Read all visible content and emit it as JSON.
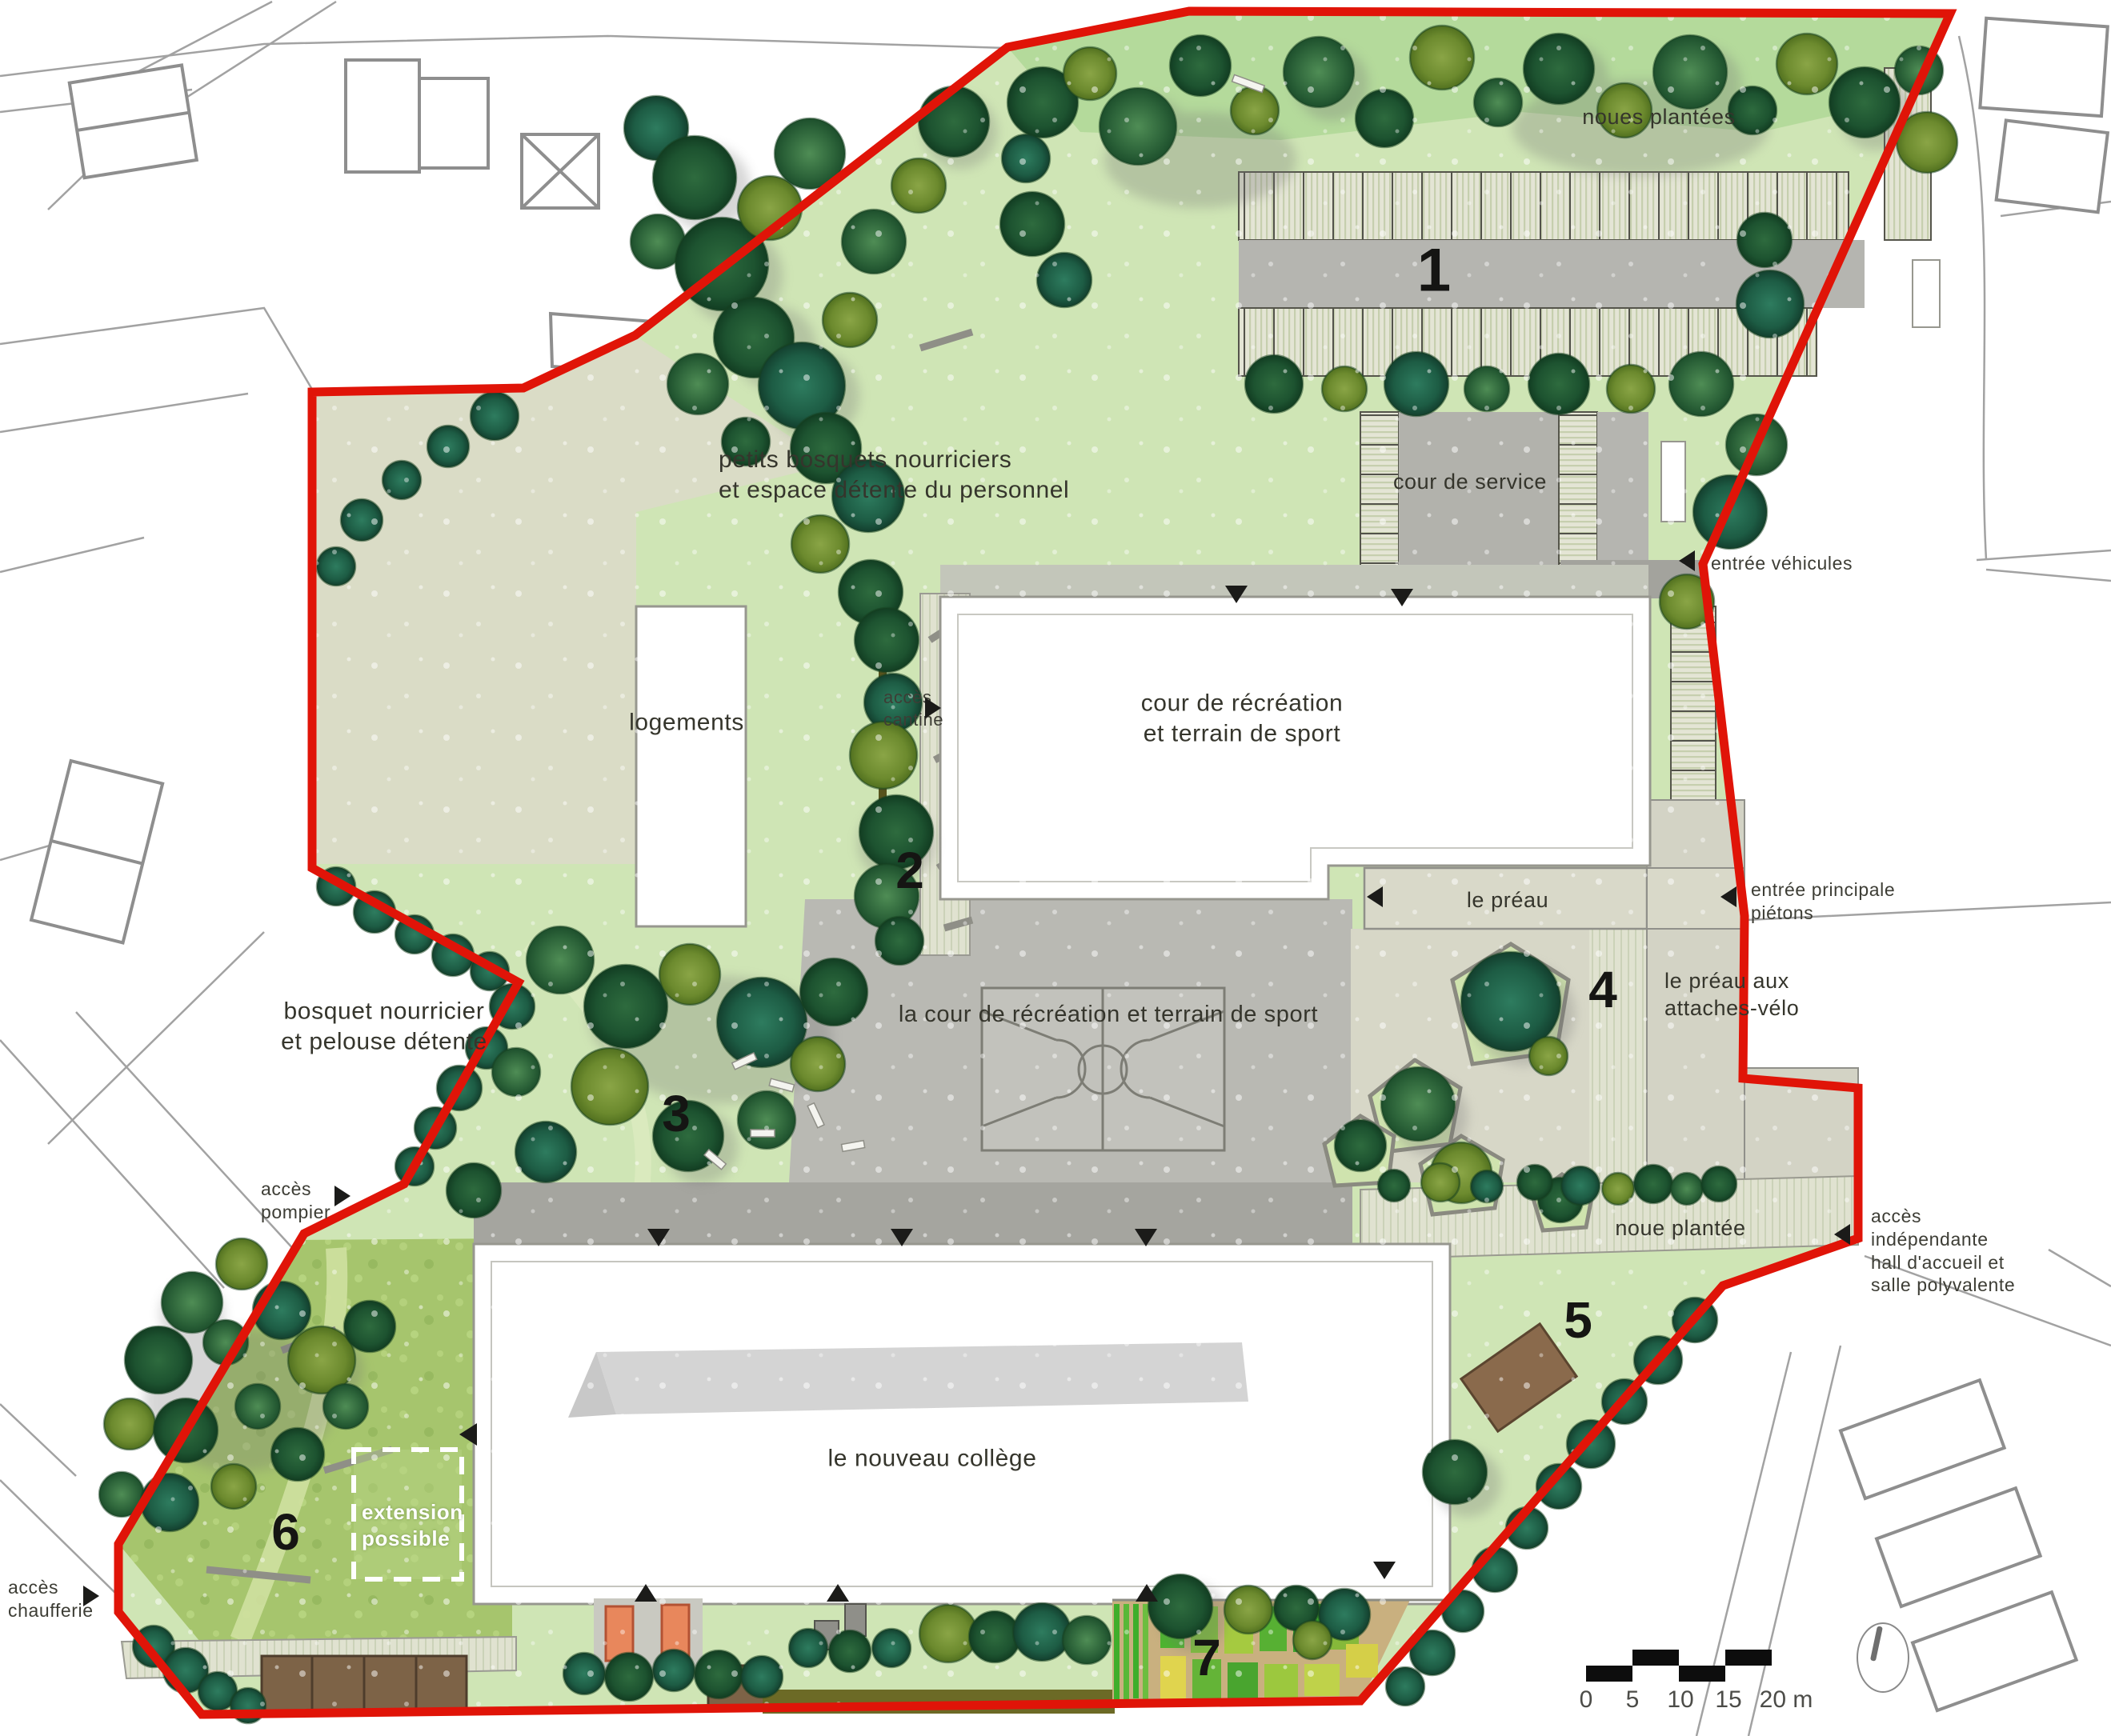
{
  "plan": {
    "labels": {
      "noues_plantees": "noues plantées",
      "cour_de_service": "cour de service",
      "entree_vehicules": "entrée véhicules",
      "petits_bosquets_1": "petits bosquets nourriciers",
      "petits_bosquets_2": "et espace détente du personnel",
      "logements": "logements",
      "acces_cantine_1": "accès",
      "acces_cantine_2": "cantine",
      "cour_recreation_1": "cour de récréation",
      "cour_recreation_2": "et terrain de sport",
      "le_preau": "le préau",
      "entree_principale_1": "entrée principale",
      "entree_principale_2": "piétons",
      "preau_velo_1": "le préau aux",
      "preau_velo_2": "attaches-vélo",
      "bosquet_1": "bosquet nourricier",
      "bosquet_2": "et pelouse détente",
      "la_cour": "la cour de récréation et terrain de sport",
      "acces_pompier_1": "accès",
      "acces_pompier_2": "pompier",
      "noue_plantee": "noue plantée",
      "acces_independante_1": "accès",
      "acces_independante_2": "indépendante",
      "acces_independante_3": "hall d'accueil et",
      "acces_independante_4": "salle polyvalente",
      "college": "le nouveau collège",
      "extension_1": "extension",
      "extension_2": "possible",
      "acces_chaufferie_1": "accès",
      "acces_chaufferie_2": "chaufferie"
    },
    "zone_numbers": {
      "parking": "1",
      "jardin_cantine": "2",
      "bosquet": "3",
      "preau_velo": "4",
      "noue": "5",
      "meadow": "6",
      "potager": "7"
    },
    "scale_bar": {
      "t0": "0",
      "t1": "5",
      "t2": "10",
      "t3": "15",
      "t4": "20 m"
    },
    "colors": {
      "boundary_red": "#e01408",
      "lawn_green": "#cfe5b5",
      "meadow_green": "#a6c56d",
      "paving_gray": "#b7b7b1",
      "tree_dark_green": "#1d5330",
      "wood_brown": "#7d6347",
      "accent_orange": "#e8875c"
    }
  }
}
